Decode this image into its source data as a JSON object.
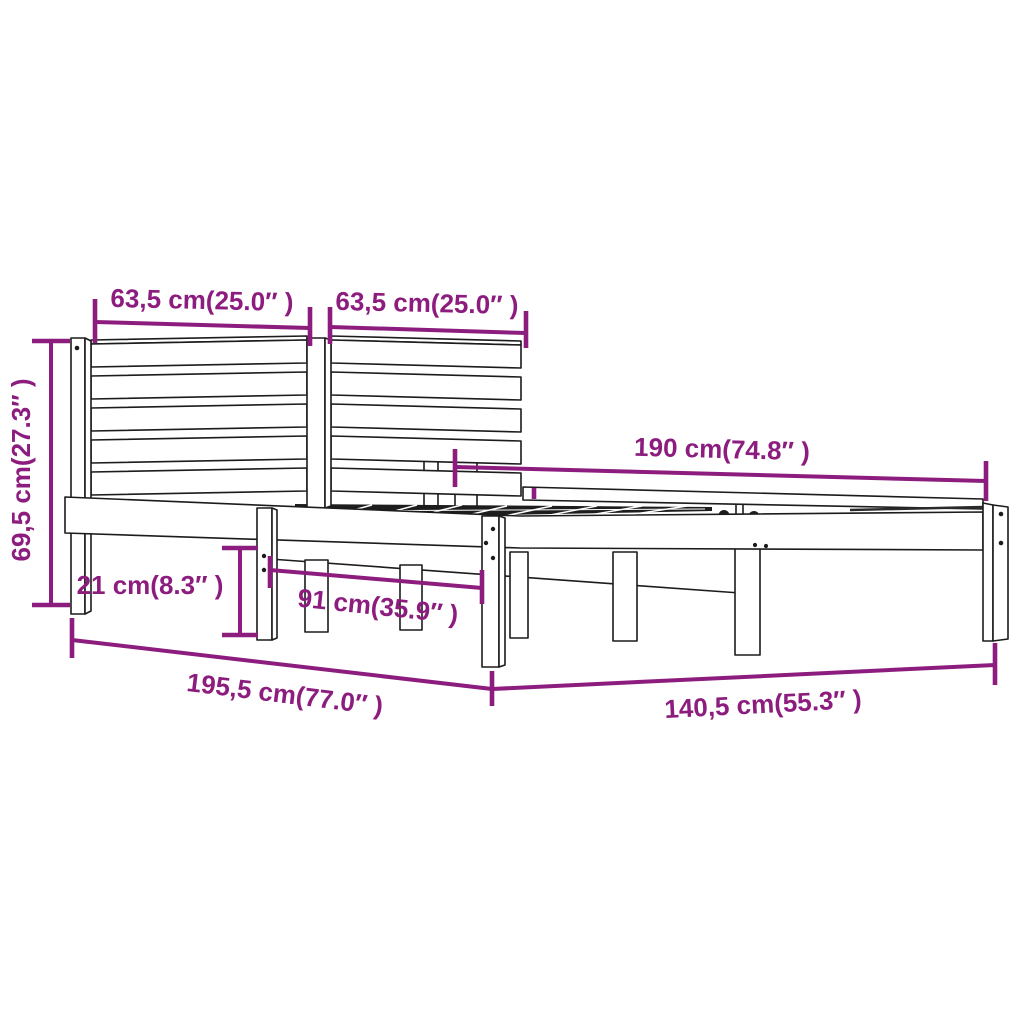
{
  "document": {
    "title": "Bed frame dimension diagram",
    "background_color": "#ffffff"
  },
  "style": {
    "dimension_color": "#8C1D7E",
    "line_art_color": "#1c1c1c"
  },
  "product": {
    "kind": "wooden bed frame with slatted headboard",
    "view": "perspective line drawing with dimension callouts"
  },
  "dimensions": {
    "headboard_left": {
      "label": "63,5 cm(25.0″ )",
      "value_cm": "63,5",
      "value_in": "25.0"
    },
    "headboard_right": {
      "label": "63,5 cm(25.0″ )",
      "value_cm": "63,5",
      "value_in": "25.0"
    },
    "inner_length": {
      "label": "190 cm(74.8″ )",
      "value_cm": "190",
      "value_in": "74.8"
    },
    "headboard_height": {
      "label": "69,5 cm(27.3″ )",
      "value_cm": "69,5",
      "value_in": "27.3"
    },
    "rail_height": {
      "label": "21 cm(8.3″ )",
      "value_cm": "21",
      "value_in": "8.3"
    },
    "leg_spacing": {
      "label": "91 cm(35.9″ )",
      "value_cm": "91",
      "value_in": "35.9"
    },
    "total_length": {
      "label": "195,5 cm(77.0″ )",
      "value_cm": "195,5",
      "value_in": "77.0"
    },
    "total_width": {
      "label": "140,5 cm(55.3″ )",
      "value_cm": "140,5",
      "value_in": "55.3"
    }
  }
}
